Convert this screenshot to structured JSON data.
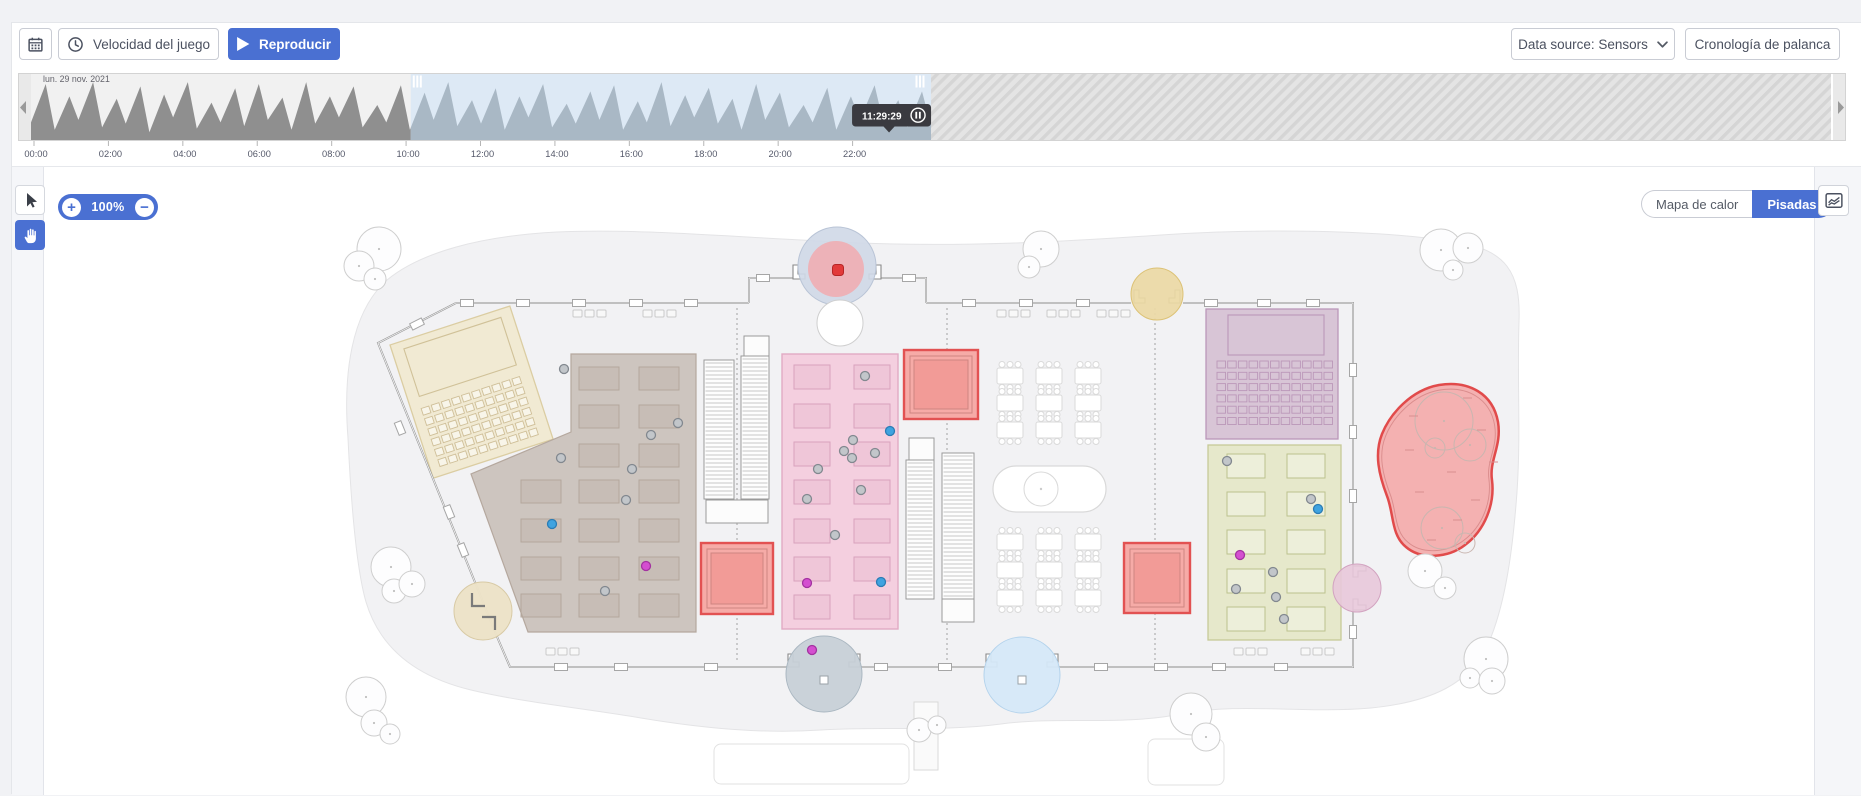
{
  "toolbar": {
    "speed_button": "Velocidad del juego",
    "play_button": "Reproducir",
    "data_source_button": "Data source: Sensors",
    "lever_timeline_button": "Cronología de palanca"
  },
  "timeline": {
    "date_label": "lun. 29 nov. 2021",
    "tick_labels": [
      "00:00",
      "02:00",
      "04:00",
      "06:00",
      "08:00",
      "10:00",
      "12:00",
      "14:00",
      "16:00",
      "18:00",
      "20:00",
      "22:00"
    ],
    "tooltip_time": "11:29:29",
    "selection_start": 0.211,
    "selection_end": 0.5,
    "playhead": 0.4767,
    "wave_peaks": [
      0.92,
      0.72,
      0.95,
      0.68,
      0.88,
      0.75,
      0.95,
      0.62,
      0.85,
      0.92,
      0.7,
      0.95,
      0.72,
      0.88,
      0.58,
      0.9,
      0.78,
      0.95,
      0.66,
      0.85,
      0.72,
      0.92,
      0.6,
      0.8,
      0.9,
      0.64,
      0.95,
      0.74,
      0.86,
      0.68,
      0.92,
      0.78,
      0.58,
      0.86,
      0.72,
      0.9,
      0.66,
      0.8
    ],
    "wave_valleys": [
      0.3,
      0.18,
      0.34,
      0.22,
      0.28,
      0.14,
      0.38,
      0.2,
      0.3,
      0.24,
      0.34,
      0.18,
      0.28,
      0.38,
      0.22,
      0.3,
      0.18,
      0.34,
      0.24,
      0.28,
      0.18,
      0.38,
      0.22,
      0.28,
      0.34,
      0.18,
      0.3,
      0.24,
      0.38,
      0.28,
      0.18,
      0.34,
      0.22,
      0.3,
      0.18,
      0.34,
      0.28,
      0.22
    ]
  },
  "map_controls": {
    "zoom_level": "100%",
    "zoom_in": "+",
    "zoom_out": "−",
    "heatmap_toggle": "Mapa de calor",
    "footsteps_toggle": "Pisadas"
  },
  "map": {
    "colors": {
      "accent": "#4a70d2",
      "alert_red": "#e23a3a",
      "person": {
        "gray": {
          "fill": "#c2c6ca",
          "stroke": "#82888f"
        },
        "blue": {
          "fill": "#3fa3e0",
          "stroke": "#2b7cb4"
        },
        "magenta": {
          "fill": "#d44fd0",
          "stroke": "#a332a0"
        }
      }
    },
    "people": [
      {
        "x": 563,
        "y": 367,
        "c": "gray"
      },
      {
        "x": 677,
        "y": 421,
        "c": "gray"
      },
      {
        "x": 650,
        "y": 433,
        "c": "gray"
      },
      {
        "x": 560,
        "y": 456,
        "c": "gray"
      },
      {
        "x": 631,
        "y": 467,
        "c": "gray"
      },
      {
        "x": 625,
        "y": 498,
        "c": "gray"
      },
      {
        "x": 604,
        "y": 589,
        "c": "gray"
      },
      {
        "x": 551,
        "y": 522,
        "c": "blue"
      },
      {
        "x": 645,
        "y": 564,
        "c": "magenta"
      },
      {
        "x": 864,
        "y": 374,
        "c": "gray"
      },
      {
        "x": 889,
        "y": 429,
        "c": "blue"
      },
      {
        "x": 852,
        "y": 438,
        "c": "gray"
      },
      {
        "x": 843,
        "y": 449,
        "c": "gray"
      },
      {
        "x": 851,
        "y": 456,
        "c": "gray"
      },
      {
        "x": 874,
        "y": 451,
        "c": "gray"
      },
      {
        "x": 817,
        "y": 467,
        "c": "gray"
      },
      {
        "x": 860,
        "y": 488,
        "c": "gray"
      },
      {
        "x": 806,
        "y": 497,
        "c": "gray"
      },
      {
        "x": 834,
        "y": 533,
        "c": "gray"
      },
      {
        "x": 806,
        "y": 581,
        "c": "magenta"
      },
      {
        "x": 880,
        "y": 580,
        "c": "blue"
      },
      {
        "x": 1226,
        "y": 459,
        "c": "gray"
      },
      {
        "x": 1310,
        "y": 497,
        "c": "gray"
      },
      {
        "x": 1317,
        "y": 507,
        "c": "blue"
      },
      {
        "x": 1239,
        "y": 553,
        "c": "magenta"
      },
      {
        "x": 1272,
        "y": 570,
        "c": "gray"
      },
      {
        "x": 1235,
        "y": 587,
        "c": "gray"
      },
      {
        "x": 1275,
        "y": 595,
        "c": "gray"
      },
      {
        "x": 1283,
        "y": 617,
        "c": "gray"
      },
      {
        "x": 811,
        "y": 648,
        "c": "magenta"
      }
    ]
  },
  "icons": {
    "calendar": "calendar-icon",
    "speed": "clock-icon",
    "play": "play-icon",
    "data_source": "chevron-down-icon",
    "select": "cursor-icon",
    "pan": "hand-icon",
    "zoom_in": "plus-icon",
    "zoom_out": "minus-icon",
    "analytics": "area-chart-icon",
    "pause": "pause-icon",
    "timeline_prev": "chevron-left-icon",
    "timeline_next": "chevron-right-icon"
  }
}
